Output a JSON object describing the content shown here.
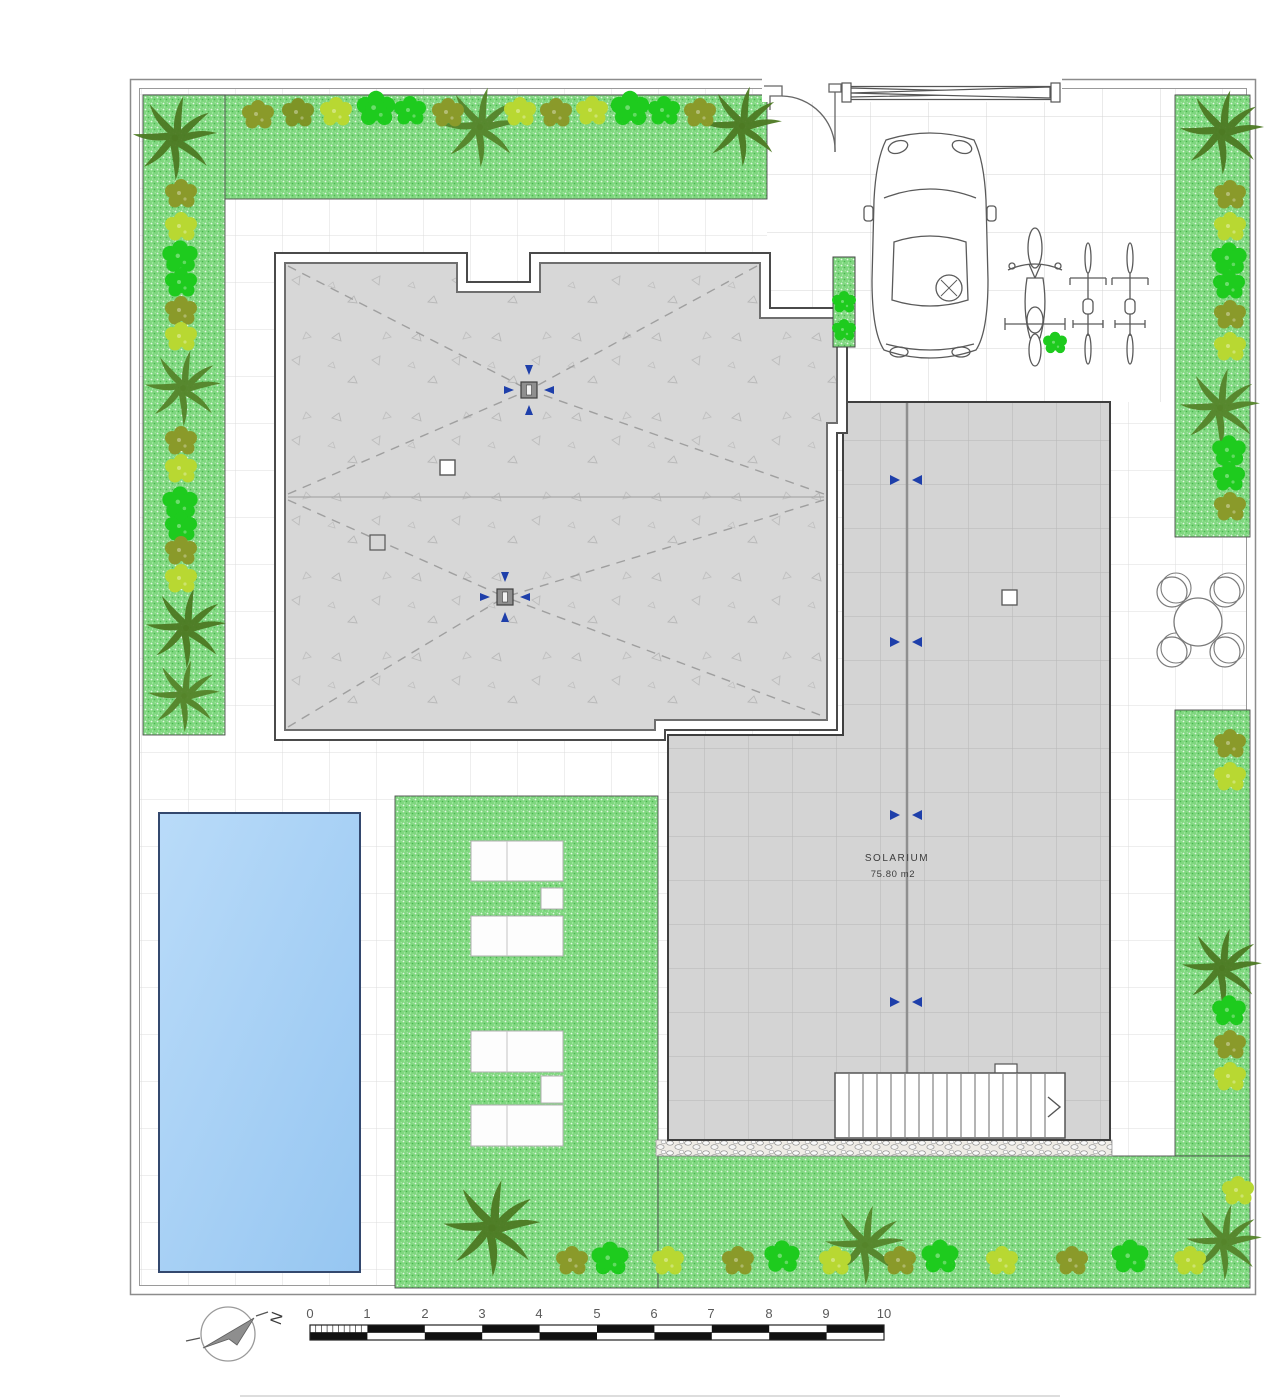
{
  "plan": {
    "solarium": {
      "label": "SOLARIUM",
      "area": "75.80 m2"
    },
    "scale_bar": {
      "labels": [
        "0",
        "1",
        "2",
        "3",
        "4",
        "5",
        "6",
        "7",
        "8",
        "9",
        "10"
      ]
    },
    "north_arrow": {
      "label": "N"
    }
  },
  "colors": {
    "grass": "#7FD77F",
    "roof_concrete": "#D7D7D7",
    "solarium_tile": "#D4D4D4",
    "pool_water": "#A9D2F6",
    "drain_arrow_blue": "#1E3FAA",
    "bush_olive": "#8A9A2A",
    "bush_yellow_green": "#B8D832",
    "bush_bright_green": "#1ECB1E",
    "palm_green": "#4D7A23",
    "outline_dark": "#444444"
  }
}
